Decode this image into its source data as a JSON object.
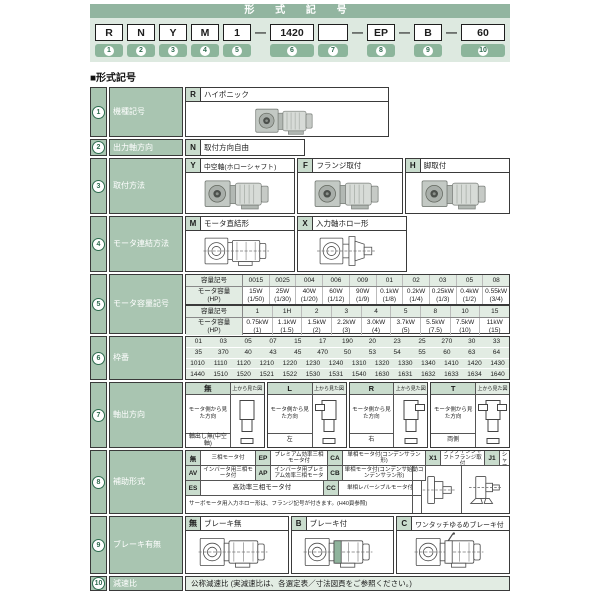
{
  "header": {
    "title": "形 式 記 号",
    "dash": "—",
    "codes": {
      "c1": {
        "box": "R",
        "num": "1"
      },
      "c2": {
        "box": "N",
        "num": "2"
      },
      "c3": {
        "box": "Y",
        "num": "3"
      },
      "c4": {
        "box": "M",
        "num": "4"
      },
      "c5": {
        "box": "1",
        "num": "5"
      },
      "c6": {
        "box": "1420",
        "num": "6"
      },
      "c7": {
        "box": "",
        "num": "7"
      },
      "c8": {
        "box": "EP",
        "num": "8"
      },
      "c9": {
        "box": "B",
        "num": "9"
      },
      "c10": {
        "box": "60",
        "num": "10"
      }
    }
  },
  "section_title": "■形式記号",
  "rows": {
    "r1": {
      "num": "1",
      "label": "機種記号",
      "code": "R",
      "desc": "ハイポニック"
    },
    "r2": {
      "num": "2",
      "label": "出力軸方向",
      "code": "N",
      "desc": "取付方向自由"
    },
    "r3": {
      "num": "3",
      "label": "取付方法",
      "opts": [
        {
          "code": "Y",
          "desc": "中空軸(ホローシャフト)"
        },
        {
          "code": "F",
          "desc": "フランジ取付"
        },
        {
          "code": "H",
          "desc": "脚取付"
        }
      ]
    },
    "r4": {
      "num": "4",
      "label": "モータ連結方法",
      "opts": [
        {
          "code": "M",
          "desc": "モータ直結形"
        },
        {
          "code": "X",
          "desc": "入力軸ホロー形"
        }
      ]
    },
    "r5": {
      "num": "5",
      "label": "モータ容量記号",
      "sym_label": "容量記号",
      "cap_label": "モータ容量",
      "hp_label": "(HP)",
      "t1": [
        {
          "sym": "0015",
          "cap": "15W",
          "hp": "(1/50)"
        },
        {
          "sym": "0025",
          "cap": "25W",
          "hp": "(1/30)"
        },
        {
          "sym": "004",
          "cap": "40W",
          "hp": "(1/20)"
        },
        {
          "sym": "006",
          "cap": "60W",
          "hp": "(1/12)"
        },
        {
          "sym": "009",
          "cap": "90W",
          "hp": "(1/9)"
        },
        {
          "sym": "01",
          "cap": "0.1kW",
          "hp": "(1/8)"
        },
        {
          "sym": "02",
          "cap": "0.2kW",
          "hp": "(1/4)"
        },
        {
          "sym": "03",
          "cap": "0.25kW",
          "hp": "(1/3)"
        },
        {
          "sym": "05",
          "cap": "0.4kW",
          "hp": "(1/2)"
        },
        {
          "sym": "08",
          "cap": "0.55kW",
          "hp": "(3/4)"
        }
      ],
      "t2": [
        {
          "sym": "1",
          "cap": "0.75kW",
          "hp": "(1)"
        },
        {
          "sym": "1H",
          "cap": "1.1kW",
          "hp": "(1.5)"
        },
        {
          "sym": "2",
          "cap": "1.5kW",
          "hp": "(2)"
        },
        {
          "sym": "3",
          "cap": "2.2kW",
          "hp": "(3)"
        },
        {
          "sym": "4",
          "cap": "3.0kW",
          "hp": "(4)"
        },
        {
          "sym": "5",
          "cap": "3.7kW",
          "hp": "(5)"
        },
        {
          "sym": "8",
          "cap": "5.5kW",
          "hp": "(7.5)"
        },
        {
          "sym": "10",
          "cap": "7.5kW",
          "hp": "(10)"
        },
        {
          "sym": "15",
          "cap": "11kW",
          "hp": "(15)"
        }
      ]
    },
    "r6": {
      "num": "6",
      "label": "枠番",
      "line1": [
        "01",
        "03",
        "05",
        "07",
        "15",
        "17",
        "190",
        "20",
        "23",
        "25",
        "270",
        "30",
        "33"
      ],
      "line2": [
        "35",
        "370",
        "40",
        "43",
        "45",
        "470",
        "50",
        "53",
        "54",
        "55",
        "60",
        "63",
        "64"
      ],
      "line3": [
        "1010",
        "1110",
        "1120",
        "1210",
        "1220",
        "1230",
        "1240",
        "1310",
        "1320",
        "1330",
        "1340",
        "1410",
        "1420",
        "1430"
      ],
      "line4": [
        "1440",
        "1510",
        "1520",
        "1521",
        "1522",
        "1530",
        "1531",
        "1540",
        "1630",
        "1631",
        "1632",
        "1633",
        "1634",
        "1640"
      ]
    },
    "r7": {
      "num": "7",
      "label": "軸出方向",
      "top_view_label": "上から見た図",
      "view_label": "モータ側から見た方向",
      "cols": [
        {
          "code": "無",
          "value": "軸出し無(中空軸)"
        },
        {
          "code": "L",
          "value": "左"
        },
        {
          "code": "R",
          "value": "右"
        },
        {
          "code": "T",
          "value": "両側"
        }
      ]
    },
    "r8": {
      "num": "8",
      "label": "補助形式",
      "row1": [
        {
          "code": "無",
          "desc": "三相モータ付"
        },
        {
          "code": "EP",
          "desc": "プレミアム効率三相モータ付"
        },
        {
          "code": "CA",
          "desc": "単相モータ付(コンデンサラン形)"
        },
        {
          "code": "X1",
          "desc": "プラグインシャフトフランジ取付"
        },
        {
          "code": "J1",
          "desc": "プラグインシャフト脚取付"
        }
      ],
      "row2": [
        {
          "code": "AV",
          "desc": "インバータ用三相モータ付"
        },
        {
          "code": "AP",
          "desc": "インバータ用プレミアム効率三相モータ"
        },
        {
          "code": "CB",
          "desc": "単相モータ付(コンデンサ始動コンデンサラン形)"
        }
      ],
      "row3": [
        {
          "code": "ES",
          "desc": "高効率三相モータ付"
        },
        {
          "code": "CC",
          "desc": "単相レバーシブルモータ付"
        }
      ],
      "note": "サーボモータ用入力ホロー形は、フランジ記号が付きます。(H40頁参照)"
    },
    "r9": {
      "num": "9",
      "label": "ブレーキ有無",
      "opts": [
        {
          "code": "無",
          "desc": "ブレーキ無"
        },
        {
          "code": "B",
          "desc": "ブレーキ付"
        },
        {
          "code": "C",
          "desc": "ワンタッチゆるめブレーキ付"
        }
      ]
    },
    "r10": {
      "num": "10",
      "label": "減速比",
      "desc": "公称減速比 (実減速比は、各選定表／寸法図頁をご参照ください。)"
    }
  },
  "colors": {
    "header_green": "#92b5a0",
    "band_green": "#dde9e0",
    "cell_green": "#a9c5b1",
    "chip_green": "#c9dccd",
    "light_green": "#e2ece3",
    "badge_green": "#8cb59b"
  }
}
